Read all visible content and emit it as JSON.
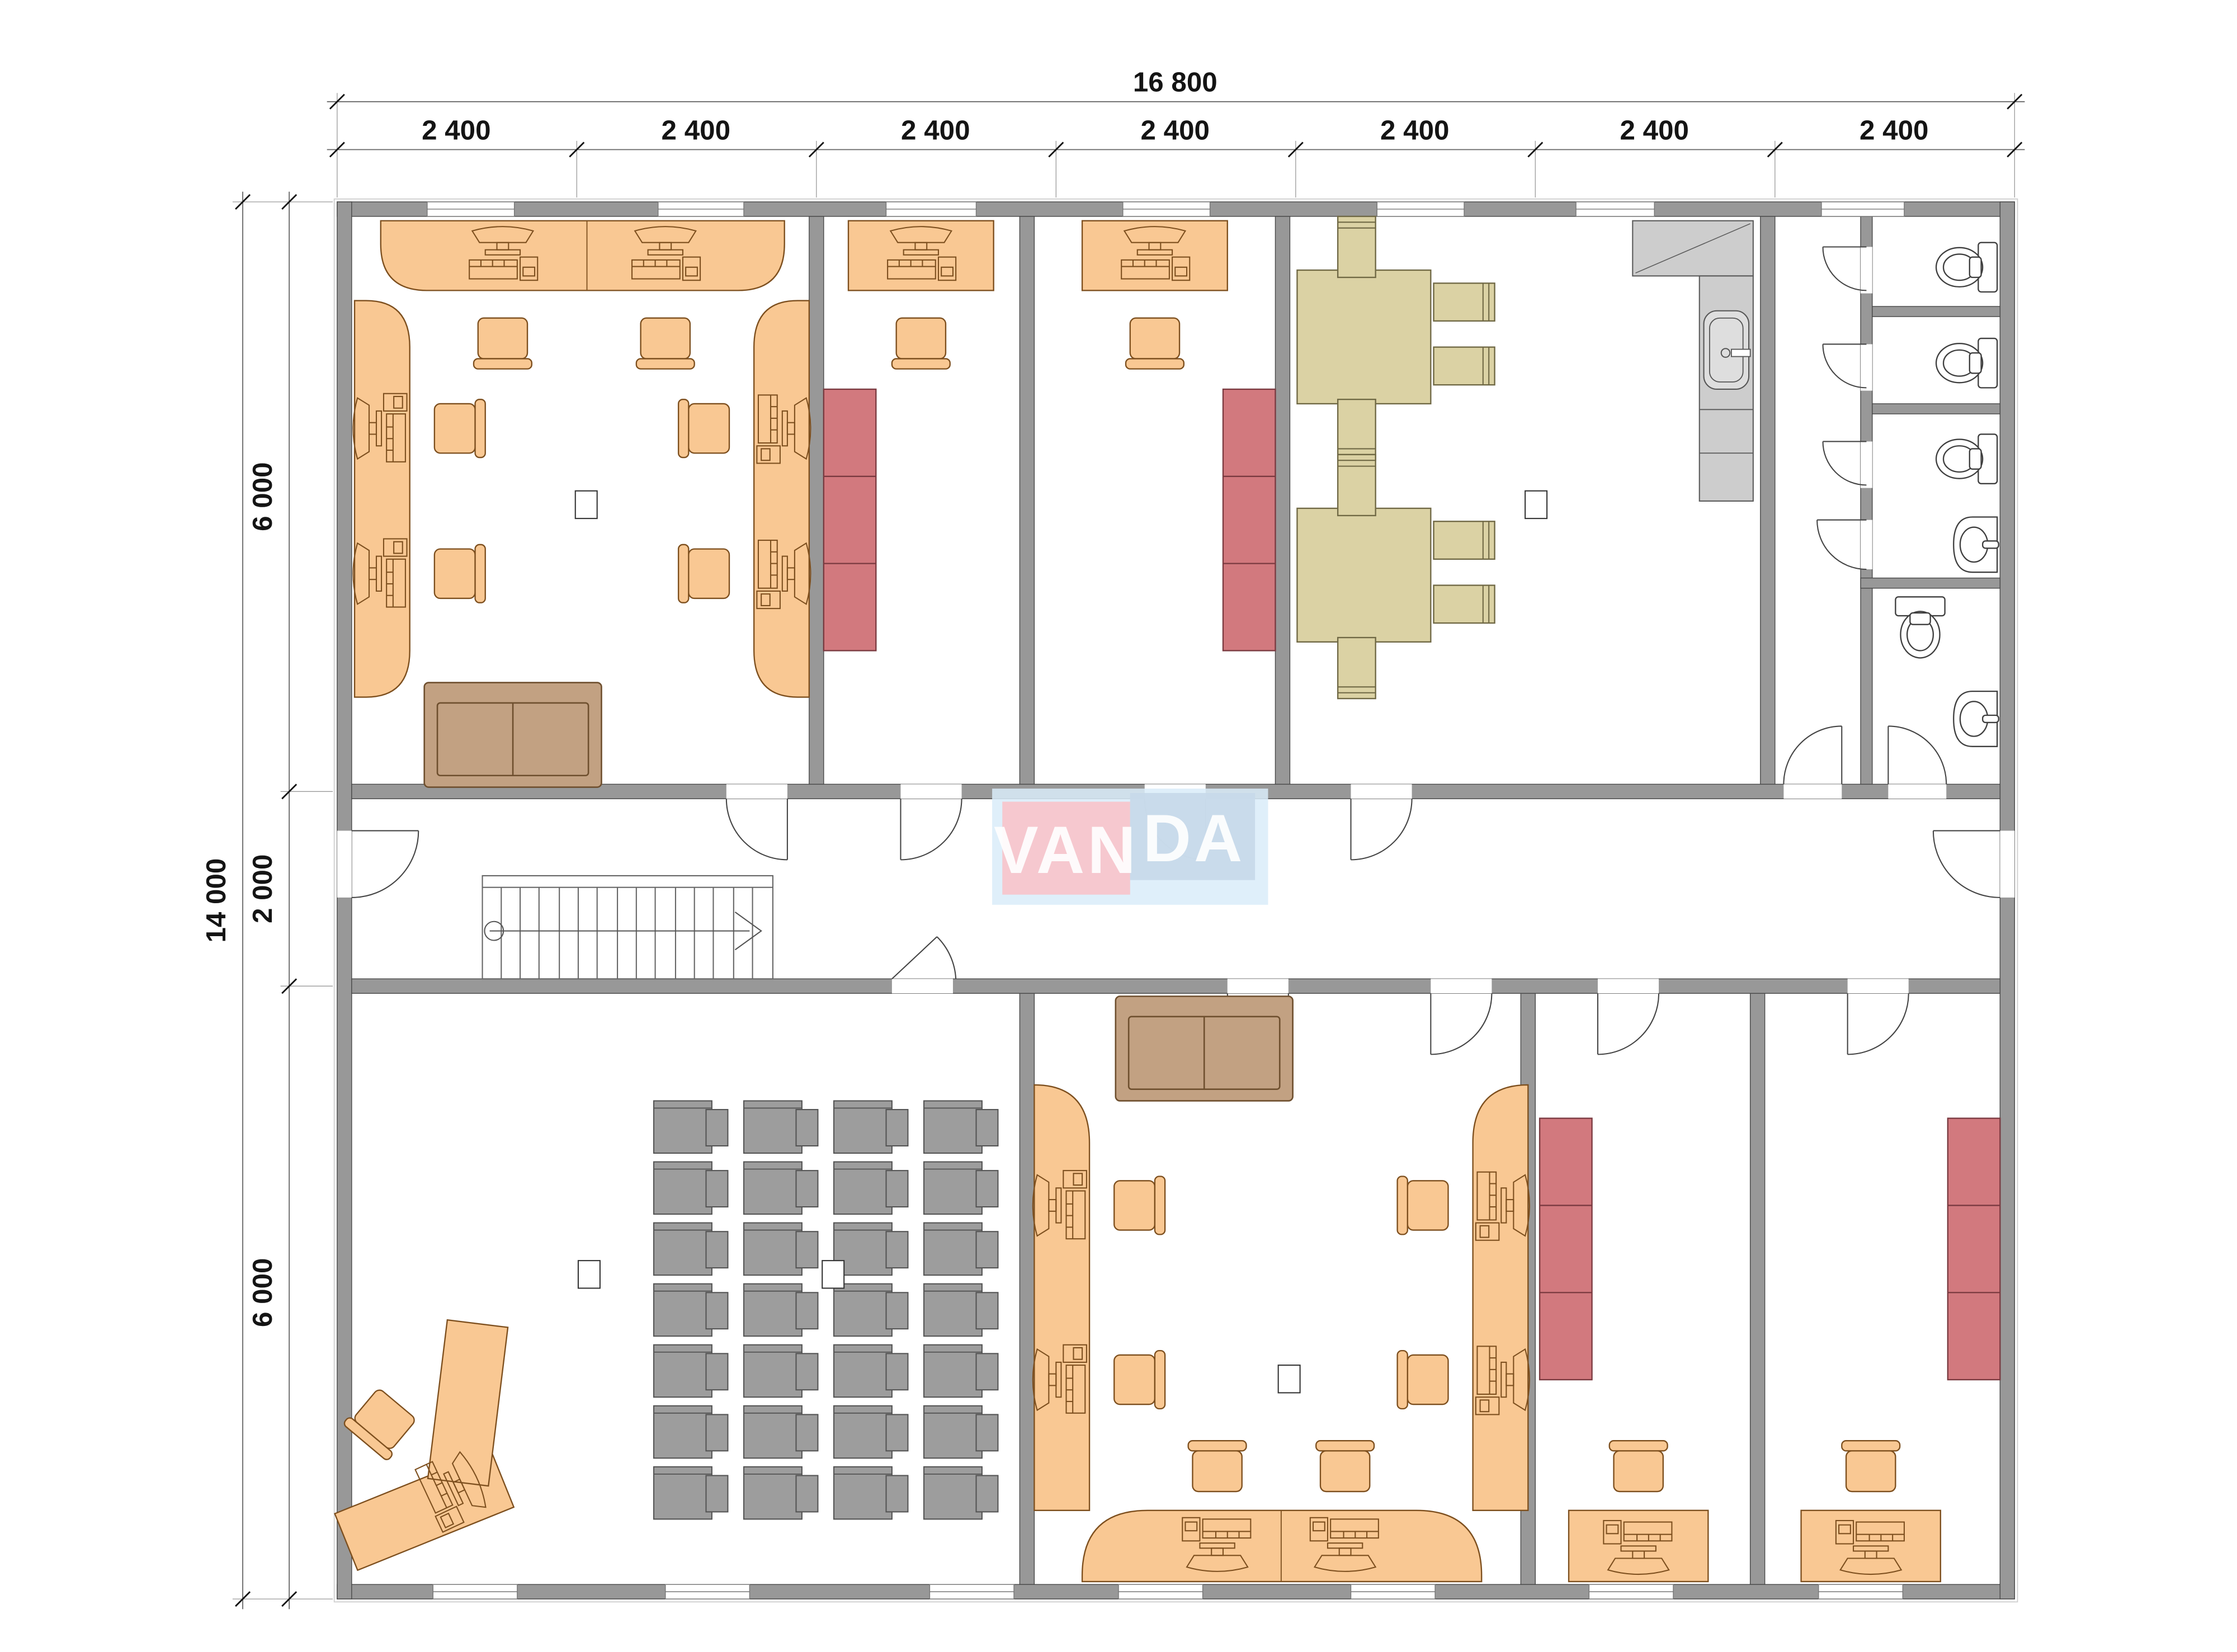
{
  "plan": {
    "type": "office-floor-plan",
    "logo": {
      "left": "VAN",
      "right": "DA"
    },
    "dimensions": {
      "top_total": "16 800",
      "top_segments": [
        "2 400",
        "2 400",
        "2 400",
        "2 400",
        "2 400",
        "2 400",
        "2 400"
      ],
      "left_total": "14 000",
      "left_segments": [
        "6 000",
        "2 000",
        "6 000"
      ]
    },
    "colors": {
      "wall": "#989898",
      "wall_edge": "#4a4a4a",
      "furn": "#f9c893",
      "furn_edge": "#7d4f1e",
      "cab_red": "#d2797e",
      "cab_red_edge": "#7a3a40",
      "tan": "#dbd2a4",
      "tan_edge": "#6f6844",
      "gdesk": "#9d9d9d",
      "gdesk_edge": "#545454",
      "kitchen": "#cdcdcd",
      "kitchen_edge": "#5a5a5a",
      "sofa": "#c2a182",
      "sofa_edge": "#6e4f2e",
      "fixture_edge": "#3f3f3f",
      "dim": "#141414",
      "dim_line": "#666666",
      "ext_line": "#9a9a9a",
      "logo_pink": "#f7c5cb",
      "logo_blue": "#c7d9e9",
      "logo_halo": "#d9ecf9",
      "logo_text": "#ffffff",
      "label_edge": "#333333"
    }
  }
}
